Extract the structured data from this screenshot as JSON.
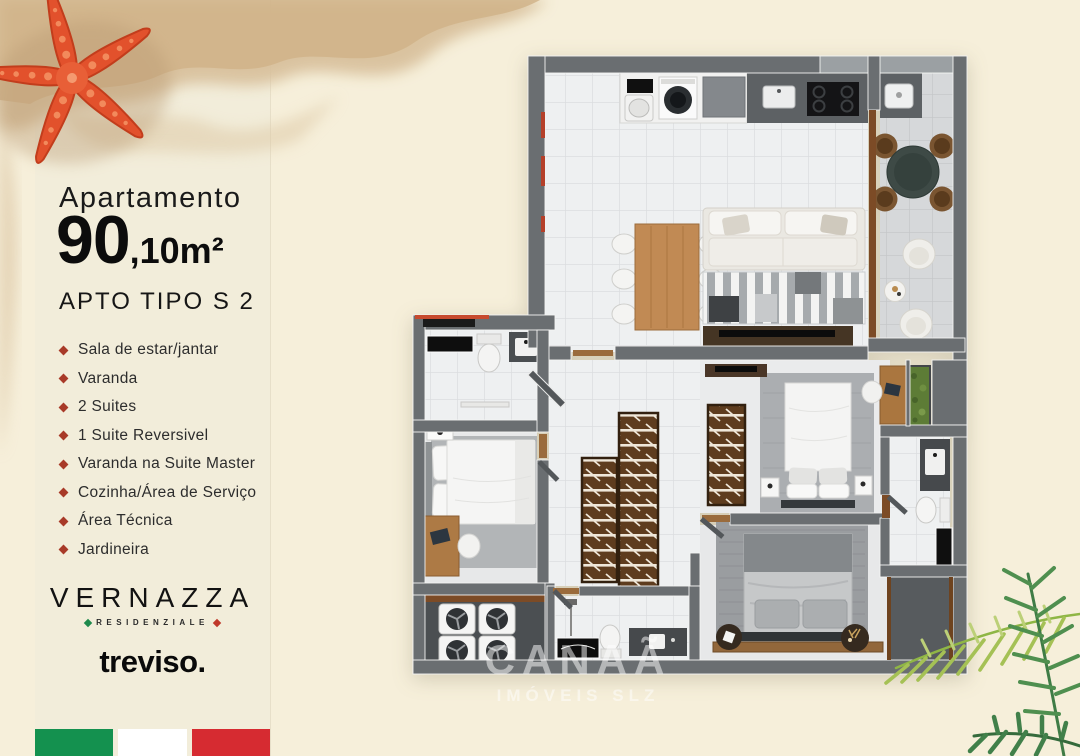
{
  "page": {
    "background_color": "#f6efda"
  },
  "panel": {
    "background_color": "#f2edda",
    "title": "Apartamento",
    "area_value": "90",
    "area_suffix": ",10m²",
    "type_label": "APTO TIPO S 2",
    "features": [
      "Sala de estar/jantar",
      "Varanda",
      "2 Suites",
      "1 Suite Reversivel",
      "Varanda na Suite Master",
      "Cozinha/Área de Serviço",
      "Área Técnica",
      "Jardineira"
    ],
    "bullet_color": "#a83a28",
    "brand": {
      "name": "VERNAZZA",
      "tagline": "RESIDENZIALE",
      "diamond_left_color": "#1f8a4c",
      "diamond_right_color": "#c0392b"
    },
    "developer_logo": "treviso.",
    "italy_flag": {
      "green": "#14914f",
      "white": "#ffffff",
      "red": "#d62b31"
    }
  },
  "floorplan": {
    "watermark_line1": "CANAÃ",
    "watermark_line2": "IMÓVEIS SLZ"
  },
  "decor": {
    "starfish_color": "#e2512c",
    "sand_color": "#d9c29d",
    "palm_green_light": "#a5c155",
    "palm_green_dark": "#41804a"
  }
}
